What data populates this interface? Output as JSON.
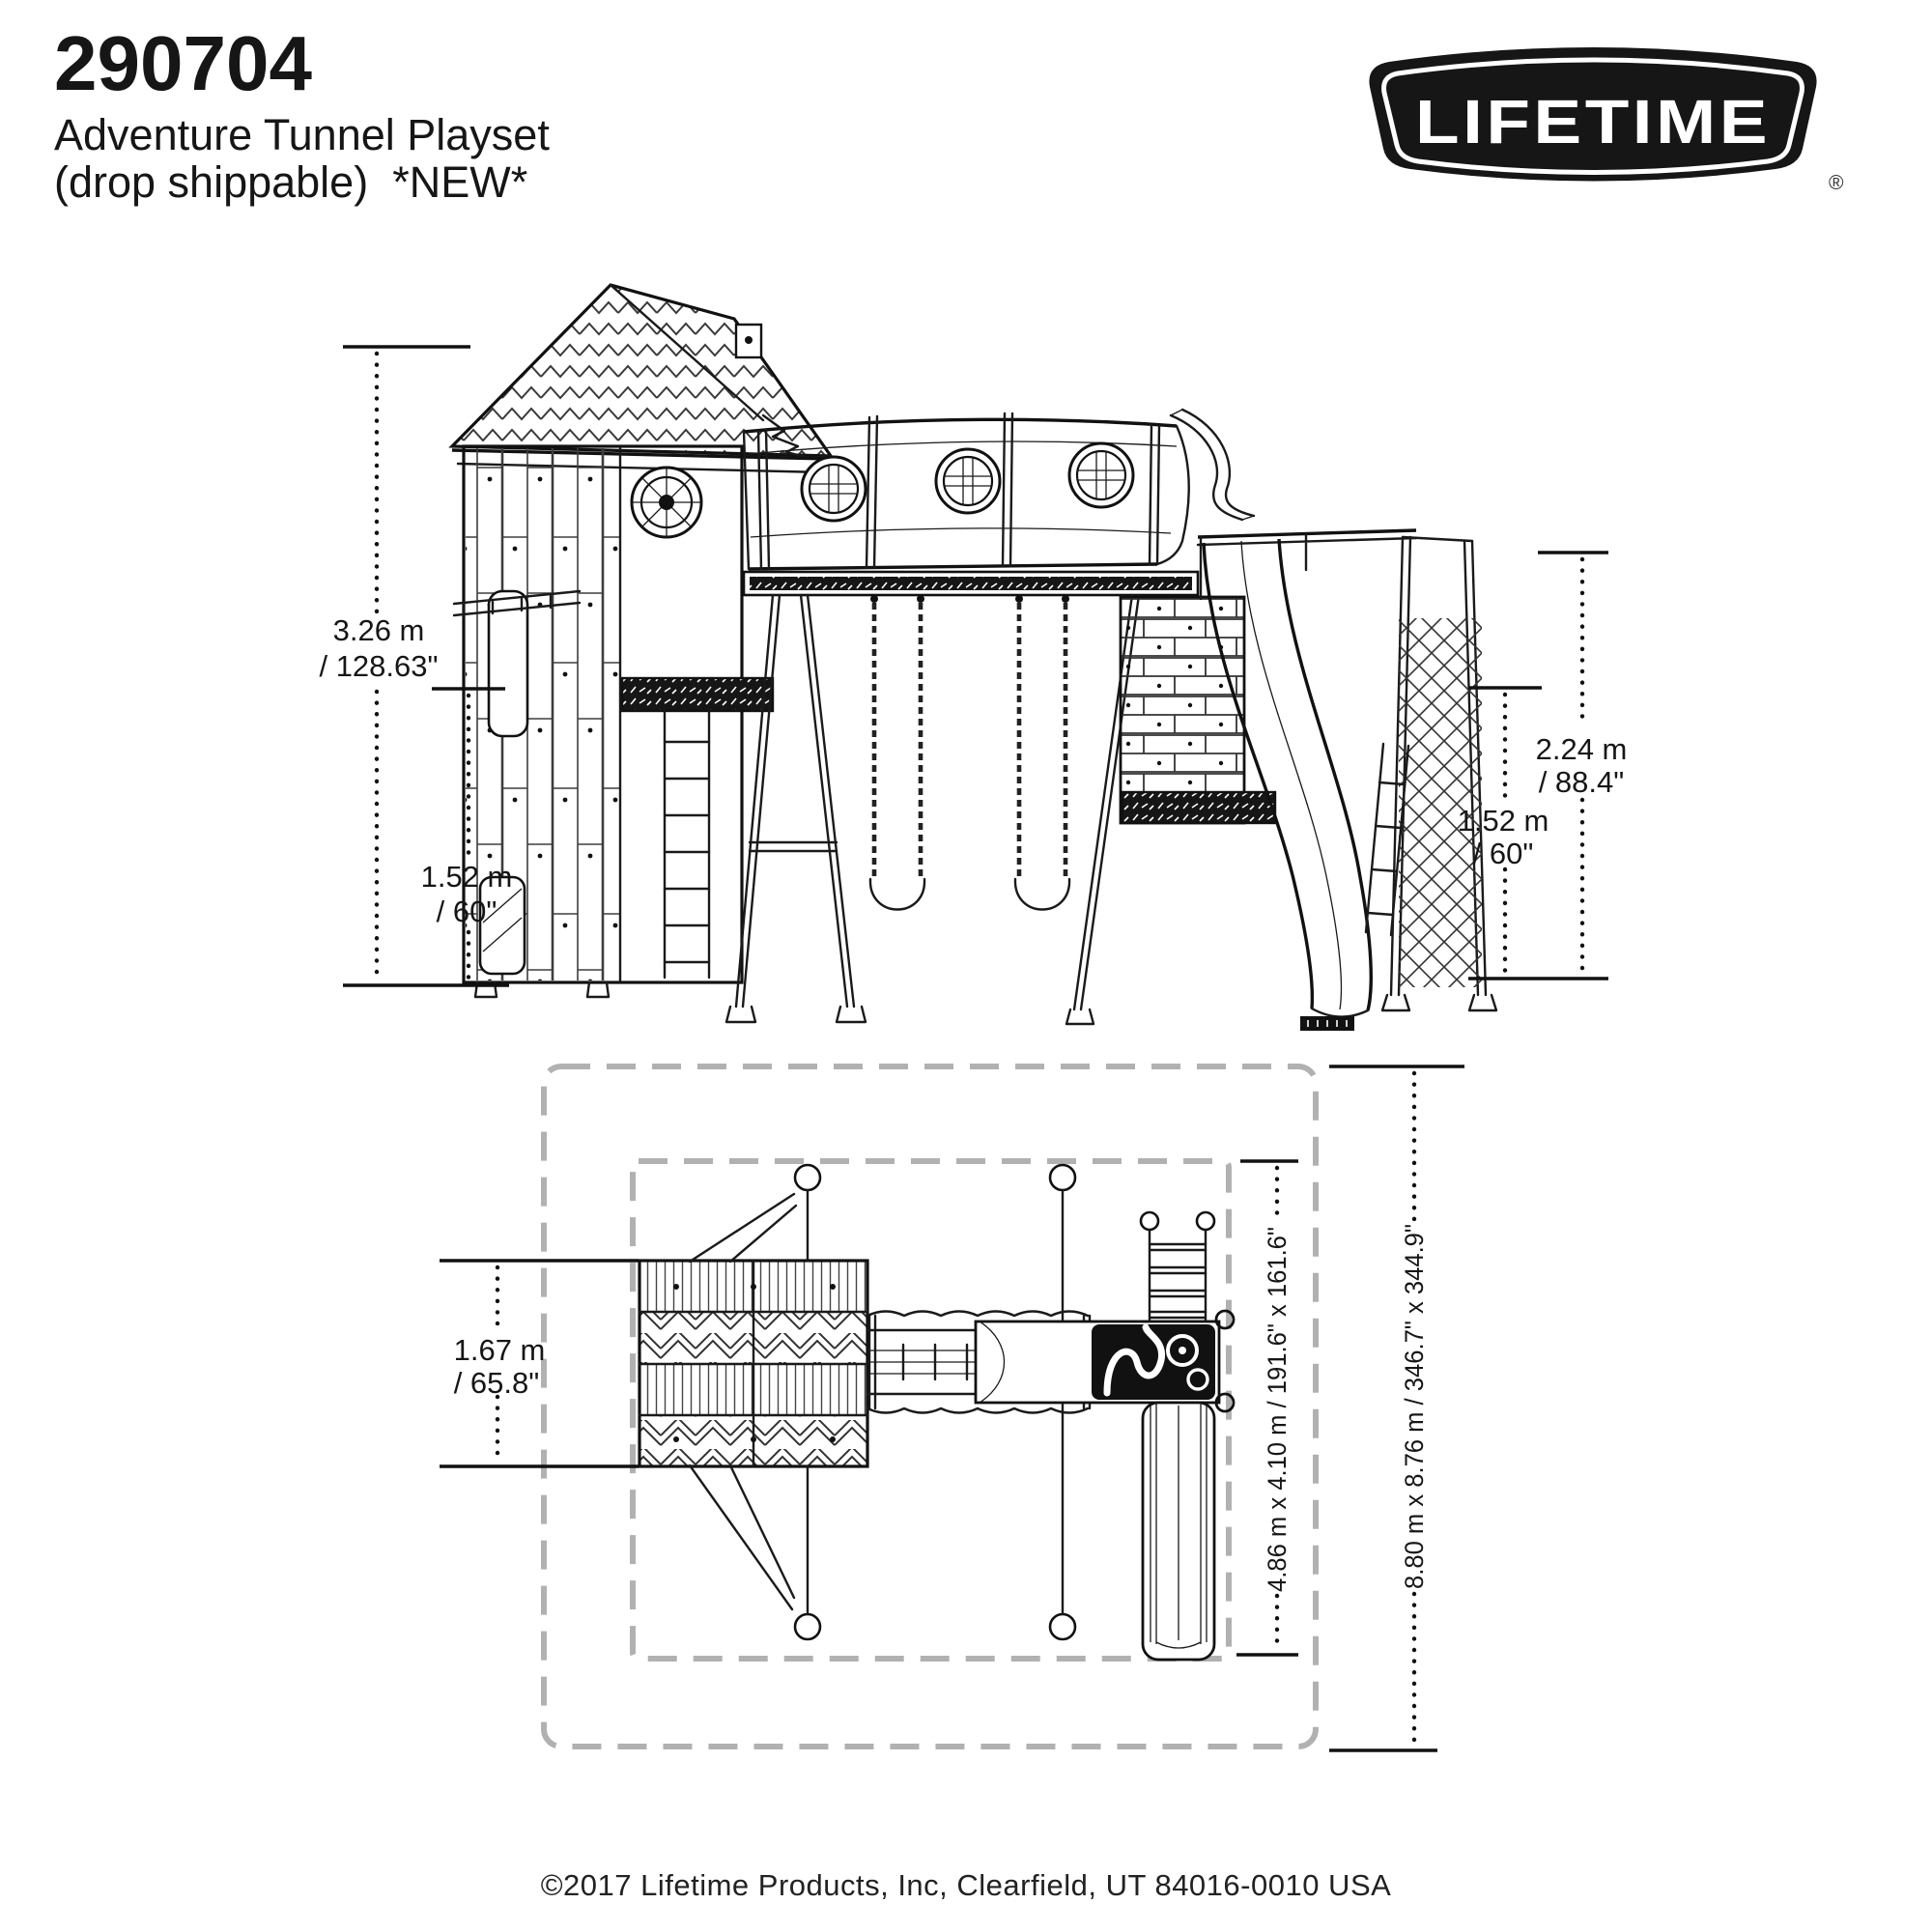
{
  "header": {
    "model_number": "290704",
    "product_name": "Adventure Tunnel Playset",
    "availability_note": "(drop shippable)  *NEW*"
  },
  "logo": {
    "brand": "LIFETIME",
    "registered_mark": "®"
  },
  "side_view": {
    "dim_total_height_m": "3.26 m",
    "dim_total_height_in": "/ 128.63\"",
    "dim_left_deck_height_m": "1.52 m",
    "dim_left_deck_height_in": "/ 60\"",
    "dim_swing_beam_height_m": "2.24 m",
    "dim_swing_beam_height_in": "/ 88.4\"",
    "dim_right_deck_height_m": "1.52 m",
    "dim_right_deck_height_in": "/ 60\""
  },
  "top_view": {
    "dim_roof_depth_m": "1.67 m",
    "dim_roof_depth_in": "/ 65.8\"",
    "dim_unit_footprint": "4.86 m x 4.10 m / 191.6\" x 161.6\"",
    "dim_safety_zone": "8.80 m x 8.76 m / 346.7\" x 344.9\""
  },
  "footer": {
    "copyright": "©2017 Lifetime Products, Inc, Clearfield, UT 84016-0010 USA"
  }
}
